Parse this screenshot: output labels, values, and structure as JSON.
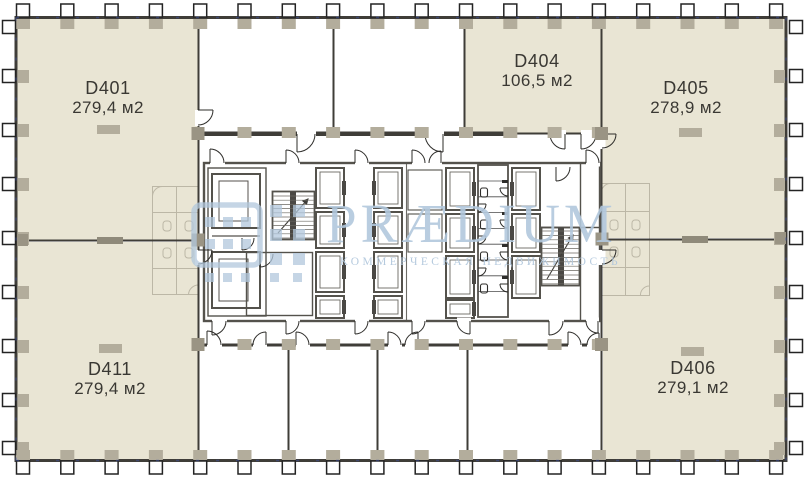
{
  "plan": {
    "units": [
      {
        "id": "D401",
        "area": "279,4 м2"
      },
      {
        "id": "D404",
        "area": "106,5 м2"
      },
      {
        "id": "D405",
        "area": "278,9 м2"
      },
      {
        "id": "D411",
        "area": "279,4 м2"
      },
      {
        "id": "D406",
        "area": "279,1 м2"
      }
    ]
  },
  "watermark": {
    "brand": "PRÆDIUM",
    "tagline": "КОММЕРЧЕСКАЯ НЕДВИЖИМОСТЬ"
  },
  "colors": {
    "unit_fill": "#e9e5d4",
    "wall": "#3f3d38",
    "core_line": "#54524c",
    "column_pad": "#b3ad9c",
    "watermark_blue": "#b2c8dd"
  }
}
